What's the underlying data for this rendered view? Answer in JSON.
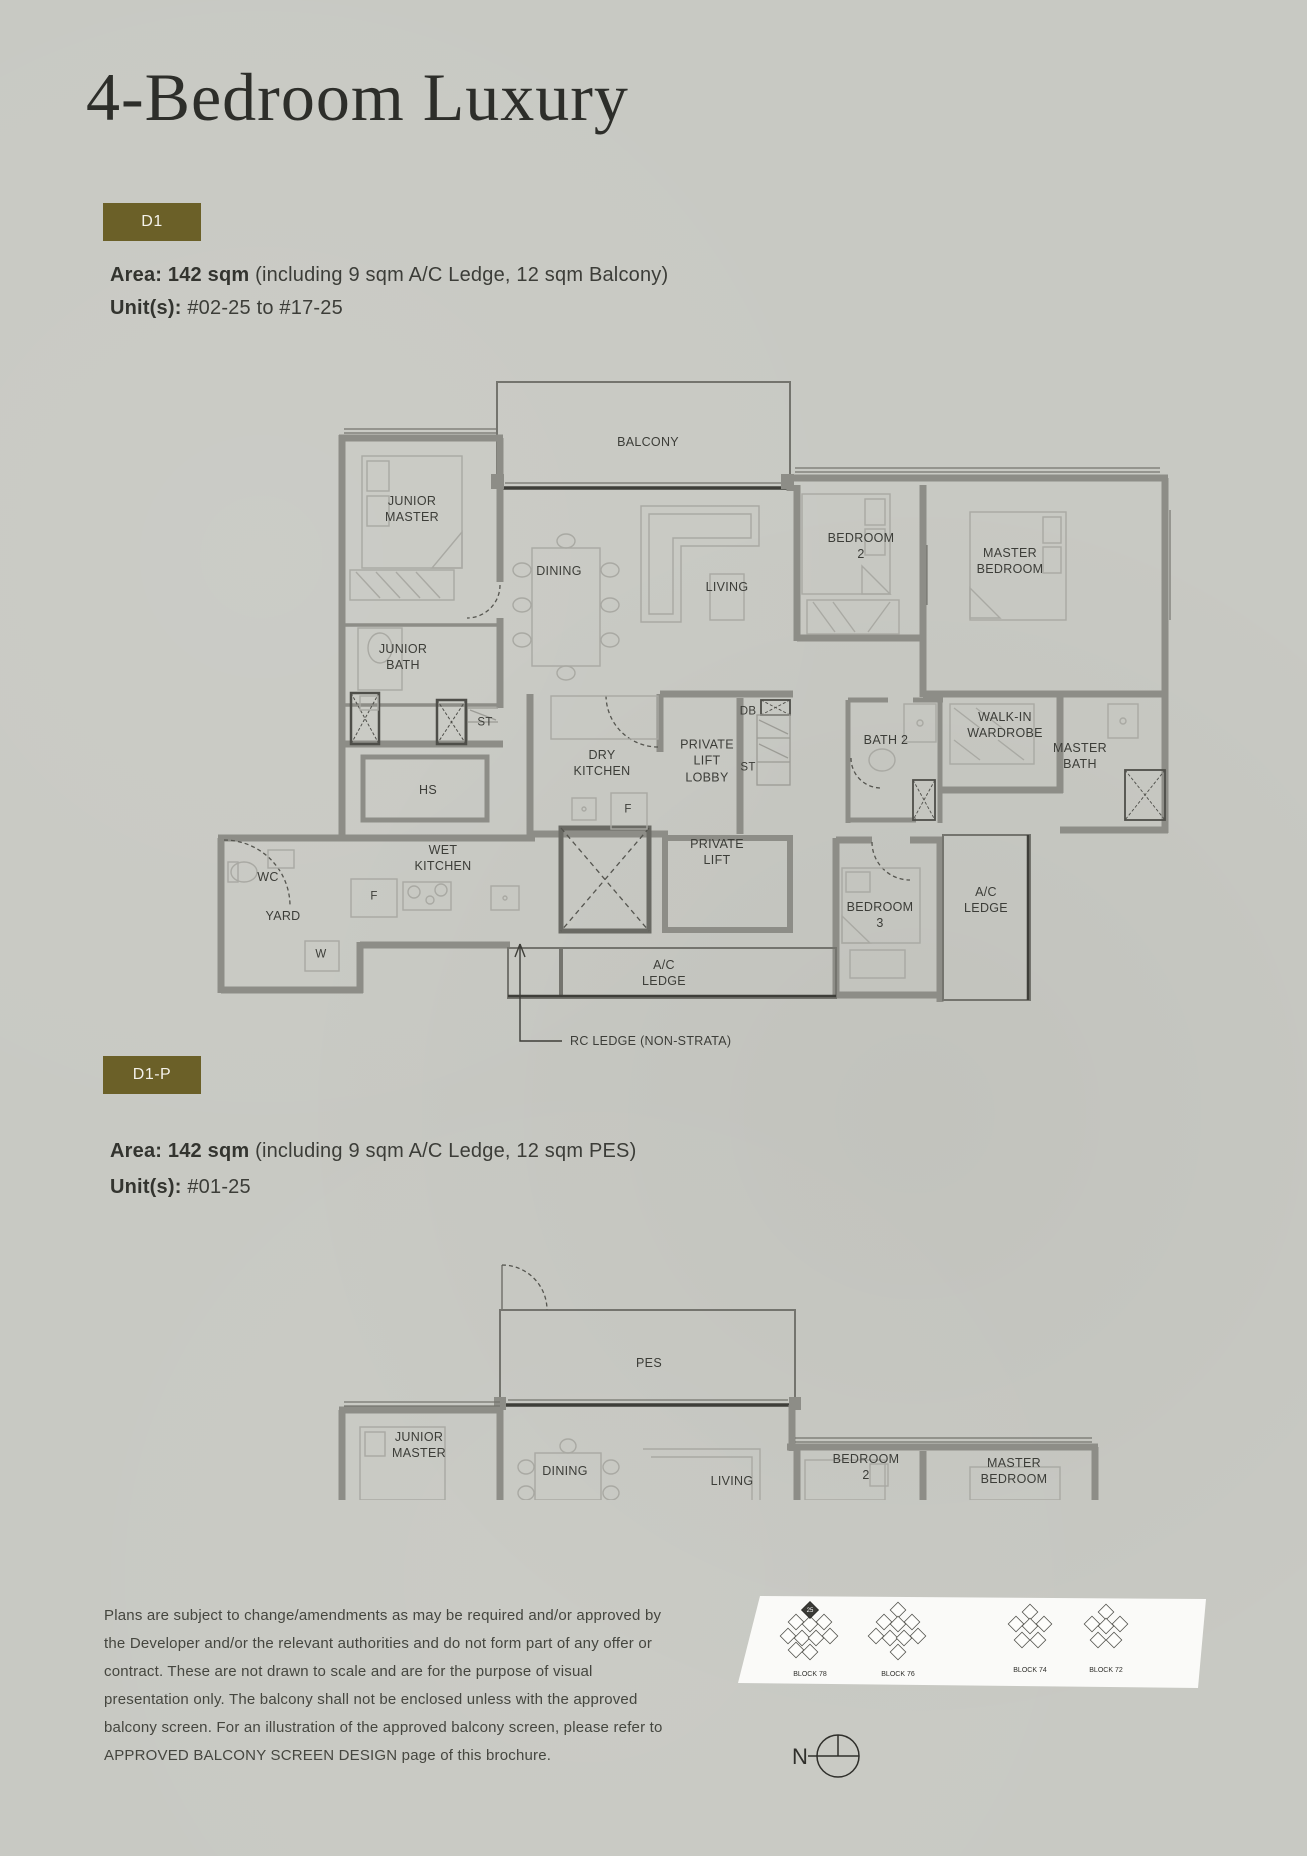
{
  "page": {
    "title": "4-Bedroom Luxury"
  },
  "colors": {
    "accent": "#6b6028",
    "background": "#c8c9c3",
    "wall": "#8d8d87",
    "text": "#3c3d38"
  },
  "d1": {
    "badge": "D1",
    "area_label": "Area: 142 sqm",
    "area_detail": " (including 9 sqm A/C Ledge, 12 sqm Balcony)",
    "unit_label": "Unit(s):",
    "unit_detail": " #02-25 to #17-25",
    "rooms": {
      "balcony": "BALCONY",
      "junior_master": "JUNIOR\nMASTER",
      "dining": "DINING",
      "living": "LIVING",
      "bedroom2": "BEDROOM\n2",
      "master_bedroom": "MASTER\nBEDROOM",
      "junior_bath": "JUNIOR\nBATH",
      "st1": "ST",
      "hs": "HS",
      "dry_kitchen": "DRY\nKITCHEN",
      "f1": "F",
      "private_lift_lobby": "PRIVATE\nLIFT\nLOBBY",
      "db": "DB",
      "st2": "ST",
      "bath2": "BATH 2",
      "walk_in_wardrobe": "WALK-IN\nWARDROBE",
      "master_bath": "MASTER\nBATH",
      "wc": "WC",
      "wet_kitchen": "WET\nKITCHEN",
      "f2": "F",
      "yard": "YARD",
      "w": "W",
      "private_lift": "PRIVATE\nLIFT",
      "bedroom3": "BEDROOM\n3",
      "ac_ledge_right": "A/C\nLEDGE",
      "ac_ledge_bottom": "A/C\nLEDGE",
      "rc_ledge": "RC LEDGE (NON-STRATA)"
    }
  },
  "d1p": {
    "badge": "D1-P",
    "area_label": "Area: 142 sqm",
    "area_detail": " (including 9 sqm A/C Ledge, 12 sqm PES)",
    "unit_label": "Unit(s):",
    "unit_detail": " #01-25",
    "rooms": {
      "pes": "PES",
      "junior_master": "JUNIOR\nMASTER",
      "dining": "DINING",
      "living": "LIVING",
      "bedroom2": "BEDROOM\n2",
      "master_bedroom": "MASTER\nBEDROOM"
    }
  },
  "footer": {
    "disclaimer": "Plans are subject to change/amendments as may be required and/or approved by\nthe Developer and/or the relevant authorities and do not form part of any offer or\ncontract. These are not drawn to scale and are for the purpose of visual\npresentation only. The balcony shall not be enclosed unless with the approved\nbalcony screen. For an illustration of the approved balcony screen, please refer to\nAPPROVED BALCONY SCREEN DESIGN page of this brochure.",
    "blocks": [
      {
        "label": "BLOCK 78"
      },
      {
        "label": "BLOCK 76"
      },
      {
        "label": "BLOCK 74"
      },
      {
        "label": "BLOCK 72"
      }
    ],
    "highlighted_unit": "25",
    "north": "N"
  }
}
